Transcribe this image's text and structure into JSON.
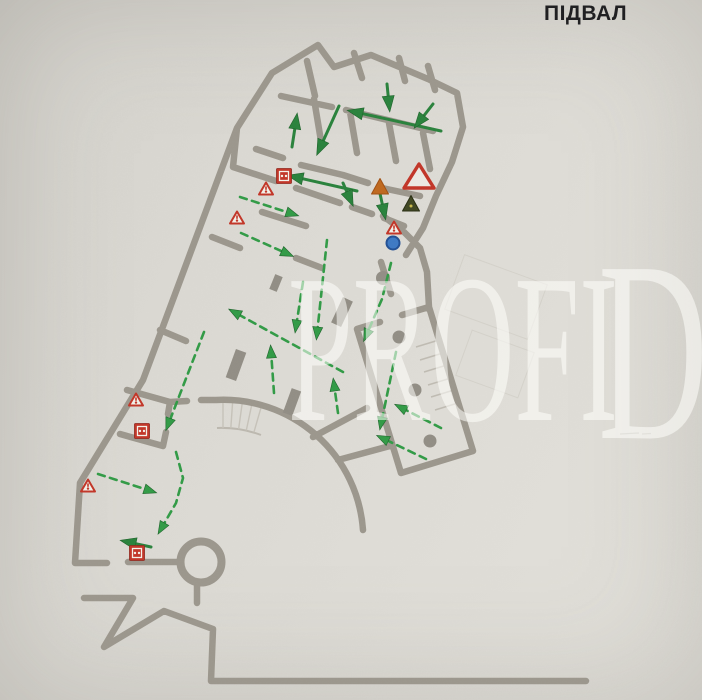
{
  "page": {
    "title": "ПІДВАЛ"
  },
  "watermark": {
    "main": "PROFI",
    "cap": "D"
  },
  "colors": {
    "wall": "#9b968c",
    "route_green": "#27813a",
    "route_green_bright": "#2f9a44",
    "alarm_red": "#c23325",
    "triangle_fill": "#f2f1ea",
    "orange": "#bf671c",
    "dark_olive": "#3e4520",
    "info_blue": "#3b78c4",
    "paper": "#dcdad4"
  },
  "plan": {
    "floor_label": "ПІДВАЛ",
    "routes_solid": [
      {
        "pts": [
          [
            441,
            131
          ],
          [
            355,
            112
          ]
        ]
      },
      {
        "pts": [
          [
            339,
            106
          ],
          [
            320,
            148
          ]
        ]
      },
      {
        "pts": [
          [
            292,
            147
          ],
          [
            296,
            121
          ]
        ]
      },
      {
        "pts": [
          [
            387,
            84
          ],
          [
            389,
            104
          ]
        ]
      },
      {
        "pts": [
          [
            433,
            104
          ],
          [
            419,
            122
          ]
        ]
      },
      {
        "pts": [
          [
            357,
            191
          ],
          [
            295,
            177
          ]
        ]
      },
      {
        "pts": [
          [
            343,
            183
          ],
          [
            350,
            199
          ]
        ]
      },
      {
        "pts": [
          [
            379,
            189
          ],
          [
            384,
            212
          ]
        ]
      },
      {
        "pts": [
          [
            151,
            547
          ],
          [
            128,
            542
          ]
        ]
      }
    ],
    "routes_dashed": [
      {
        "pts": [
          [
            240,
            197
          ],
          [
            293,
            214
          ]
        ]
      },
      {
        "pts": [
          [
            241,
            233
          ],
          [
            288,
            254
          ]
        ]
      },
      {
        "pts": [
          [
            343,
            372
          ],
          [
            234,
            312
          ]
        ]
      },
      {
        "pts": [
          [
            274,
            393
          ],
          [
            271,
            351
          ]
        ]
      },
      {
        "pts": [
          [
            303,
            282
          ],
          [
            296,
            327
          ]
        ]
      },
      {
        "pts": [
          [
            327,
            240
          ],
          [
            317,
            334
          ]
        ]
      },
      {
        "pts": [
          [
            204,
            332
          ],
          [
            168,
            425
          ]
        ]
      },
      {
        "pts": [
          [
            176,
            452
          ],
          [
            183,
            478
          ],
          [
            176,
            503
          ],
          [
            161,
            529
          ]
        ]
      },
      {
        "pts": [
          [
            98,
            474
          ],
          [
            151,
            491
          ]
        ]
      },
      {
        "pts": [
          [
            391,
            263
          ],
          [
            382,
            299
          ],
          [
            366,
            336
          ]
        ]
      },
      {
        "pts": [
          [
            441,
            428
          ],
          [
            400,
            407
          ]
        ]
      },
      {
        "pts": [
          [
            426,
            459
          ],
          [
            382,
            438
          ]
        ]
      },
      {
        "pts": [
          [
            338,
            413
          ],
          [
            334,
            384
          ]
        ]
      },
      {
        "pts": [
          [
            396,
            352
          ],
          [
            381,
            424
          ]
        ]
      }
    ],
    "symbols": [
      {
        "type": "fire-alarm-call-point",
        "x": 284,
        "y": 176
      },
      {
        "type": "fire-alarm-call-point",
        "x": 142,
        "y": 431
      },
      {
        "type": "fire-alarm-call-point",
        "x": 137,
        "y": 553
      },
      {
        "type": "warning-triangle",
        "x": 266,
        "y": 189
      },
      {
        "type": "warning-triangle",
        "x": 237,
        "y": 218
      },
      {
        "type": "warning-triangle",
        "x": 136,
        "y": 400
      },
      {
        "type": "warning-triangle",
        "x": 88,
        "y": 486
      },
      {
        "type": "warning-triangle",
        "x": 394,
        "y": 228
      },
      {
        "type": "warning-triangle-large",
        "x": 419,
        "y": 177
      },
      {
        "type": "hazard-triangle-orange",
        "x": 380,
        "y": 187
      },
      {
        "type": "hazard-triangle-dark",
        "x": 411,
        "y": 204
      },
      {
        "type": "info-point-blue",
        "x": 393,
        "y": 243
      }
    ]
  }
}
